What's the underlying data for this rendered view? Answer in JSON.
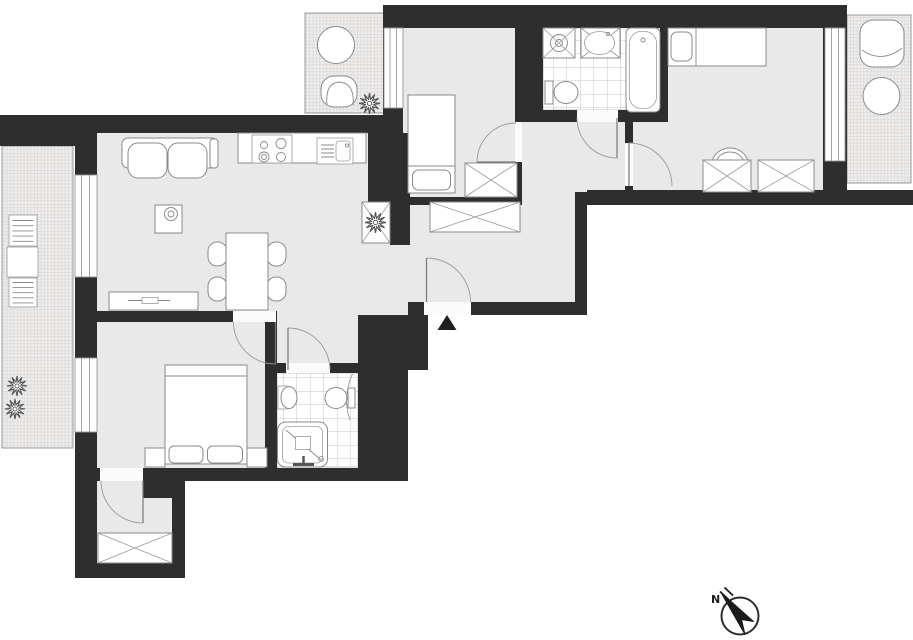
{
  "compass": {
    "north_label": "N",
    "arrow_direction": "northwest"
  },
  "entrance": {
    "marker": "triangle-arrow-up"
  },
  "colors": {
    "wall": "#2e2e2e",
    "room_floor": "#e9e9e9",
    "bathroom_tile": "#ffffff",
    "tile_line": "#bcbcbc",
    "furniture_fill": "#ffffff",
    "furniture_stroke": "#8a8a8a",
    "door_arc": "#9a9a9a",
    "balcony_hatch": "#d9d7d5",
    "background": "#ffffff"
  },
  "rooms": [
    {
      "name": "living-room-kitchen",
      "furniture": [
        "sofa",
        "side-table-with-lamp",
        "dining-table",
        "dining-chair",
        "dining-chair",
        "dining-chair",
        "dining-chair",
        "sideboard",
        "kitchen-counter",
        "stove-4-burners",
        "kitchen-sink",
        "corner-cabinet-with-plant"
      ]
    },
    {
      "name": "hall",
      "furniture": [
        "wardrobe"
      ]
    },
    {
      "name": "bedroom-small",
      "furniture": [
        "single-bed",
        "wardrobe"
      ]
    },
    {
      "name": "bathroom-main",
      "furniture": [
        "washing-machine",
        "washbasin",
        "toilet",
        "bathtub"
      ]
    },
    {
      "name": "bedroom-right",
      "furniture": [
        "single-bed",
        "chair",
        "wardrobe",
        "wardrobe"
      ]
    },
    {
      "name": "bedroom-master",
      "furniture": [
        "double-bed",
        "nightstand",
        "nightstand"
      ]
    },
    {
      "name": "bathroom-second",
      "furniture": [
        "washbasin",
        "toilet",
        "shower",
        "towel-radiator"
      ]
    },
    {
      "name": "entry-niche",
      "furniture": [
        "wardrobe"
      ]
    }
  ],
  "balconies": [
    {
      "name": "balcony-left",
      "furniture": [
        "bench",
        "table",
        "bench",
        "plant",
        "plant"
      ]
    },
    {
      "name": "balcony-top",
      "furniture": [
        "round-table",
        "wicker-chair",
        "plant"
      ]
    },
    {
      "name": "balcony-right",
      "furniture": [
        "armchair",
        "round-table"
      ]
    }
  ],
  "doors": [
    "entrance-door",
    "bedroom-small-door",
    "bathroom-main-door",
    "bedroom-right-door",
    "bedroom-master-door",
    "bathroom-second-door",
    "niche-door"
  ],
  "windows": [
    "window-living-room",
    "window-bedroom-master",
    "window-bedroom-small",
    "window-bedroom-right"
  ]
}
